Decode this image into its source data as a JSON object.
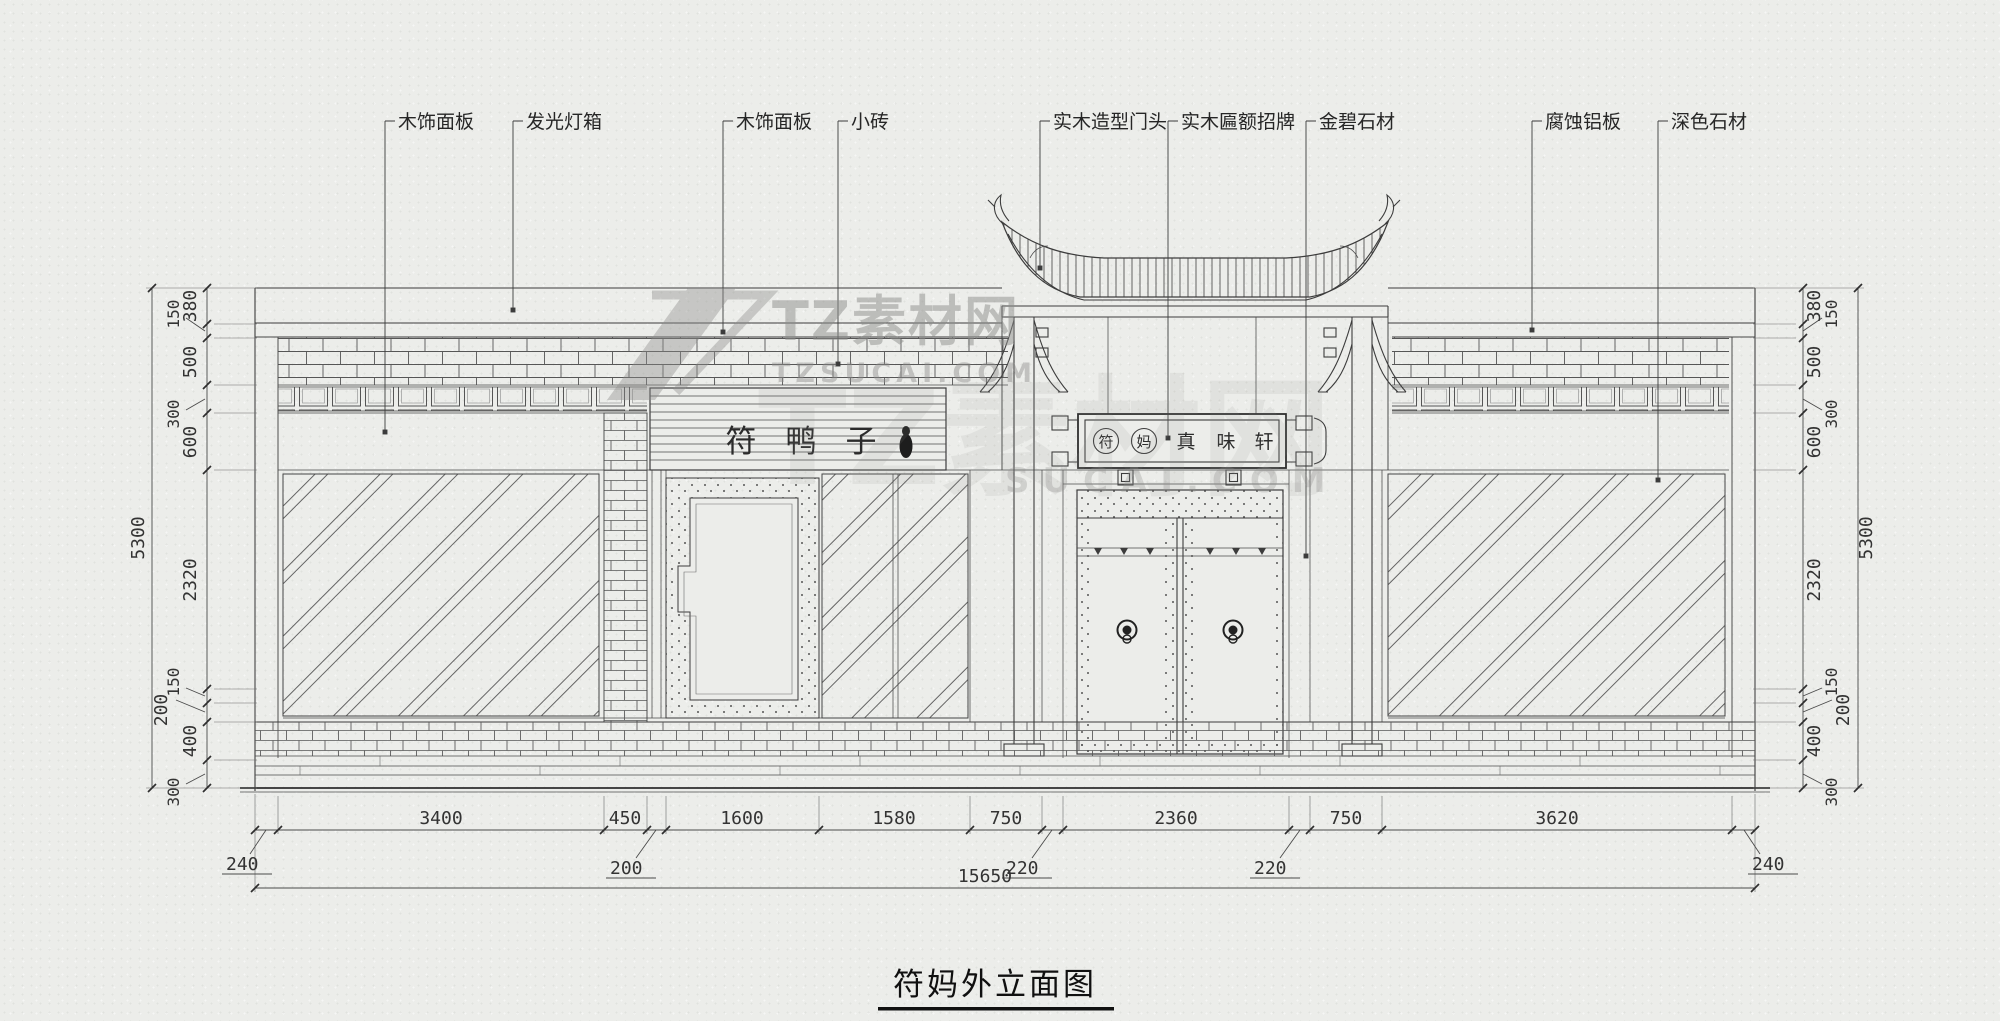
{
  "title": {
    "text": "符妈外立面图"
  },
  "callouts": [
    {
      "label": "木饰面板"
    },
    {
      "label": "发光灯箱"
    },
    {
      "label": "木饰面板"
    },
    {
      "label": "小砖"
    },
    {
      "label": "实木造型门头"
    },
    {
      "label": "实木匾额招牌"
    },
    {
      "label": "金碧石材"
    },
    {
      "label": "腐蚀铝板"
    },
    {
      "label": "深色石材"
    }
  ],
  "signs": {
    "storefront": [
      "符",
      "鸭",
      "子"
    ],
    "plaque_circled": [
      "符",
      "妈"
    ],
    "plaque_text": [
      "真",
      "味",
      "轩"
    ]
  },
  "dims": {
    "left_chain": [
      "380",
      "150",
      "500",
      "300",
      "600",
      "2320",
      "150",
      "200",
      "400",
      "300"
    ],
    "right_chain": [
      "380",
      "150",
      "500",
      "300",
      "600",
      "2320",
      "150",
      "200",
      "400",
      "300"
    ],
    "side_total_left": "5300",
    "side_total_right": "5300",
    "bottom_chain": [
      "3400",
      "450",
      "1600",
      "1580",
      "750",
      "2360",
      "750",
      "3620"
    ],
    "bottom_leaders": [
      "240",
      "200",
      "220",
      "220",
      "240"
    ],
    "bottom_total": "15650"
  },
  "watermark": {
    "brand": "TZ素材网",
    "domain": "TZSUCAI.COM",
    "ghost_brand": "TZ素材网",
    "ghost_domain": "SUCAI.COM"
  },
  "colors": {
    "ink": "#3c3c3c",
    "paper": "#ecedea",
    "watermark": "#8e8e8c"
  }
}
